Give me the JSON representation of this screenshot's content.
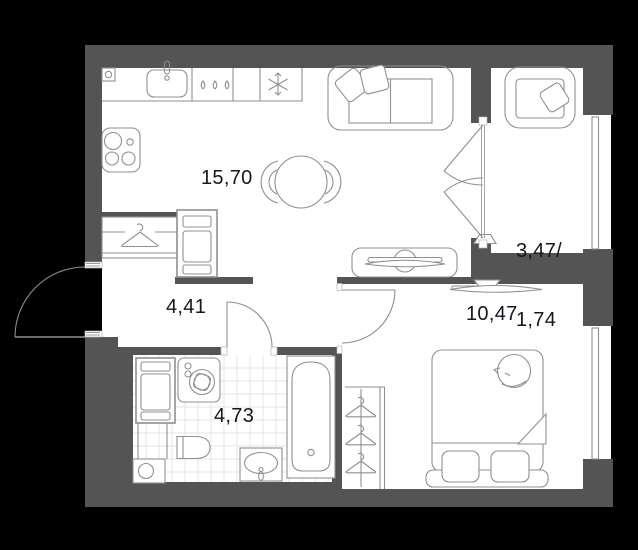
{
  "plan": {
    "colors": {
      "background": "#000000",
      "wall": "#545454",
      "floor": "#ffffff",
      "furniture_line": "#8f8f8f",
      "tile_line": "#e4e4e4",
      "label_text": "#16161e"
    },
    "rooms": [
      {
        "name": "kitchen-living-room",
        "area": "15,70"
      },
      {
        "name": "hallway",
        "area": "4,41"
      },
      {
        "name": "bathroom",
        "area": "4,73"
      },
      {
        "name": "bedroom",
        "area": "10,47"
      },
      {
        "name": "balcony",
        "area_total": "3,47/",
        "area_reduced": "1,74"
      }
    ],
    "icons": [
      "vent-icon",
      "kitchen-sink-icon",
      "faucet-icon",
      "drops-icon",
      "snowflake-icon",
      "hob-icon",
      "dining-table-icon",
      "chair-icon",
      "sofa-icon",
      "cushion-icon",
      "tv-icon",
      "tv-stand-icon",
      "armchair-icon",
      "hanger-icon",
      "cabinet-icon",
      "washing-machine-icon",
      "laundry-column-icon",
      "water-heater-icon",
      "toilet-icon",
      "wash-basin-icon",
      "bathtub-icon",
      "double-bed-icon",
      "pillow-icon",
      "cat-icon",
      "door-swing-icon",
      "window-icon"
    ]
  }
}
